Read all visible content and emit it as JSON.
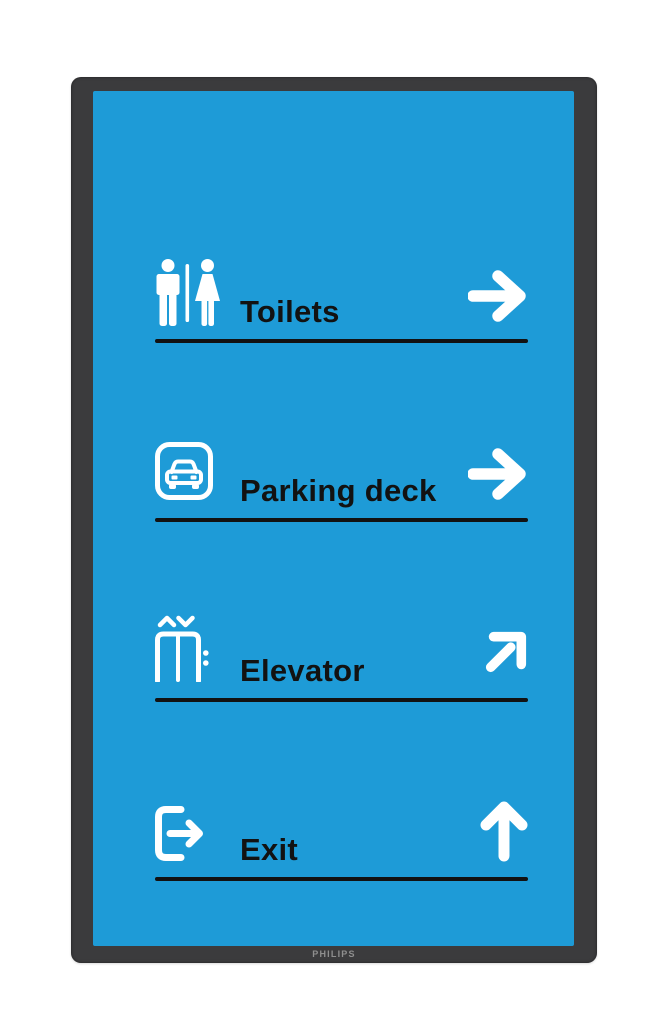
{
  "device": {
    "brand_label": "PHILIPS"
  },
  "theme": {
    "page-bg": "#ffffff",
    "bezel": "#3b3b3d",
    "screen-blue": "#1e9bd7",
    "ink": "#121212",
    "icon-white": "#ffffff",
    "brand-gray": "#8f8f8f"
  },
  "sign": {
    "rows": [
      {
        "label": "Toilets",
        "icon": "restroom-icon",
        "direction": "right"
      },
      {
        "label": "Parking deck",
        "icon": "car-parking-icon",
        "direction": "right"
      },
      {
        "label": "Elevator",
        "icon": "elevator-icon",
        "direction": "up-right"
      },
      {
        "label": "Exit",
        "icon": "exit-door-icon",
        "direction": "up"
      }
    ]
  }
}
